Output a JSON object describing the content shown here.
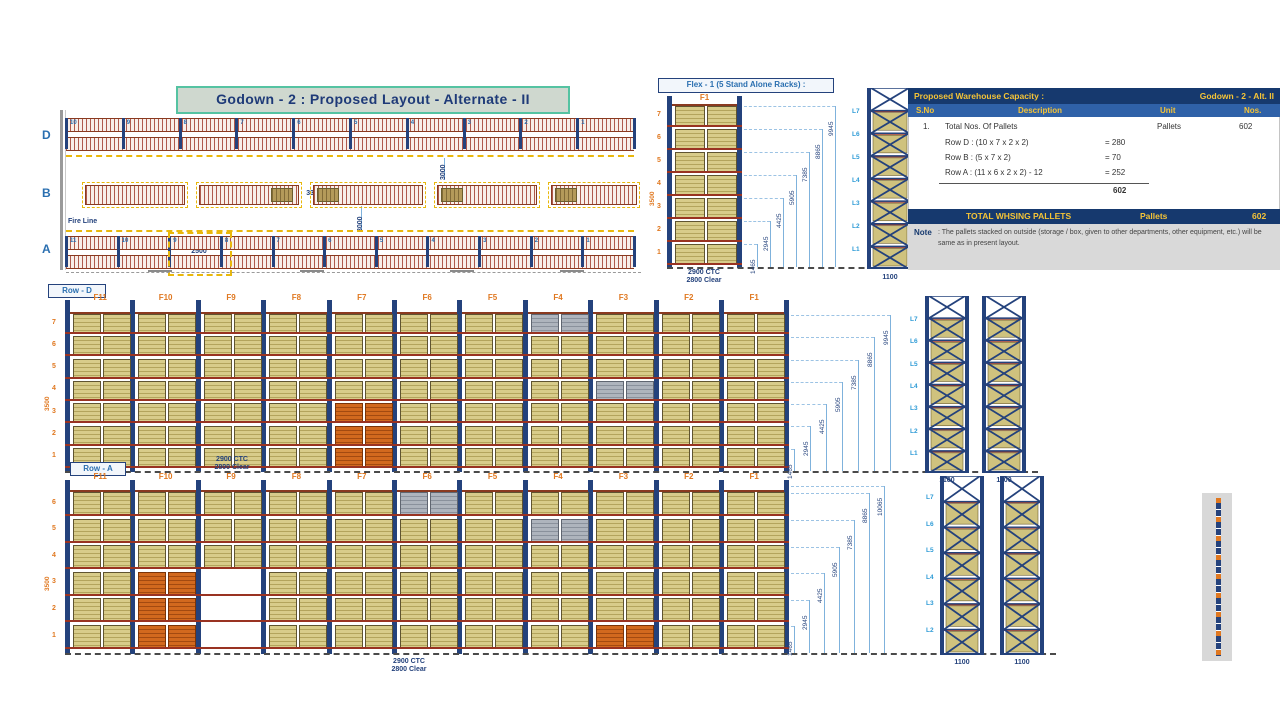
{
  "title": {
    "text": "Godown - 2 : Proposed Layout - Alternate - II"
  },
  "plan": {
    "row_d_label": "D",
    "row_b_label": "B",
    "row_a_label": "A",
    "row_d_bays": [
      "10",
      "9",
      "8",
      "7",
      "6",
      "5",
      "4",
      "3",
      "2",
      "1"
    ],
    "row_a_bays": [
      "11",
      "10",
      "9",
      "8",
      "7",
      "6",
      "5",
      "4",
      "3",
      "2",
      "1"
    ],
    "fire_line": "Fire Line",
    "dim_d_b": "3000",
    "dim_b_a": "3000",
    "dim_b_gap": "3300",
    "dim_a": "2500"
  },
  "flex": {
    "title": "Flex - 1 (5 Stand Alone Racks) :",
    "bay": "F1",
    "levels": [
      "7",
      "6",
      "5",
      "4",
      "3",
      "2",
      "1"
    ],
    "side_dim": "3500",
    "bottom_dim_l1": "2900 CTC",
    "bottom_dim_l2": "2800 Clear",
    "height_dims": [
      "1465",
      "2945",
      "4425",
      "5905",
      "7385",
      "8865",
      "9945"
    ],
    "frame_levels": [
      "L7",
      "L6",
      "L5",
      "L4",
      "L3",
      "L2",
      "L1"
    ],
    "frame_width": "1100"
  },
  "row_d": {
    "title": "Row - D",
    "bays": [
      "F11",
      "F10",
      "F9",
      "F8",
      "F7",
      "F6",
      "F5",
      "F4",
      "F3",
      "F2",
      "F1"
    ],
    "levels": [
      "7",
      "6",
      "5",
      "4",
      "3",
      "2",
      "1"
    ],
    "side_dim": "3500",
    "height_dims": [
      "1465",
      "2945",
      "4425",
      "5905",
      "7385",
      "8865",
      "9945"
    ],
    "frame_levels": [
      "L7",
      "L6",
      "L5",
      "L4",
      "L3",
      "L2",
      "L1"
    ],
    "frame_width": "1100",
    "specials": {
      "orange": [
        [
          "F7",
          1
        ],
        [
          "F7",
          2
        ],
        [
          "F7",
          3
        ]
      ],
      "gray": [
        [
          "F4",
          7
        ],
        [
          "F3",
          4
        ]
      ],
      "empty": []
    }
  },
  "row_a": {
    "title": "Row - A",
    "bays": [
      "F11",
      "F10",
      "F9",
      "F8",
      "F7",
      "F6",
      "F5",
      "F4",
      "F3",
      "F2",
      "F1"
    ],
    "levels": [
      "6",
      "5",
      "4",
      "3",
      "2",
      "1"
    ],
    "side_dim": "3500",
    "top_dim_l1": "2900 CTC",
    "top_dim_l2": "2800 Clear",
    "bottom_dim_l1": "2900 CTC",
    "bottom_dim_l2": "2800 Clear",
    "height_dims": [
      "1465",
      "2945",
      "4425",
      "5905",
      "7385",
      "8865",
      "10065"
    ],
    "frame_levels": [
      "L7",
      "L6",
      "L5",
      "L4",
      "L3",
      "L2",
      "L1"
    ],
    "frame_width": "1100",
    "specials": {
      "orange": [
        [
          "F10",
          1
        ],
        [
          "F10",
          2
        ],
        [
          "F10",
          3
        ],
        [
          "F3",
          1
        ]
      ],
      "gray": [
        [
          "F6",
          6
        ],
        [
          "F4",
          5
        ]
      ],
      "empty": [
        [
          "F9",
          1
        ],
        [
          "F9",
          2
        ],
        [
          "F9",
          3
        ]
      ]
    }
  },
  "capacity_table": {
    "header_left": "Proposed Warehouse Capacity :",
    "header_right": "Godown - 2 - Alt. II",
    "columns": [
      "S.No",
      "Description",
      "Unit",
      "Nos."
    ],
    "row": {
      "sno": "1.",
      "desc": "Total Nos. Of Pallets",
      "unit": "Pallets",
      "nos": "602"
    },
    "breakdown": [
      {
        "label": "Row D : (10 x 7 x 2 x 2)",
        "value": "= 280"
      },
      {
        "label": "Row B : (5 x 7 x 2)",
        "value": "= 70"
      },
      {
        "label": "Row A : (11 x 6 x 2 x 2) - 12",
        "value": "= 252"
      }
    ],
    "breakdown_total": "602",
    "total_label": "TOTAL WHSING PALLETS",
    "total_unit": "Pallets",
    "total_value": "602",
    "note_label": "Note",
    "note_text": ": The pallets stacked on outside (storage / box, given to other departments, other equipment, etc.) will be same as in present layout."
  },
  "colors": {
    "accent_blue": "#24427c",
    "label_orange": "#e07820",
    "beam_red": "#993322",
    "pallet_tan": "#cfc27e",
    "pallet_orange": "#cd5a17",
    "pallet_gray": "#a7adb6",
    "dim_blue": "#7fb2dc",
    "clearance_yellow": "#e9b80c",
    "table_header_bg": "#16396e",
    "table_header_text": "#f5c437"
  }
}
